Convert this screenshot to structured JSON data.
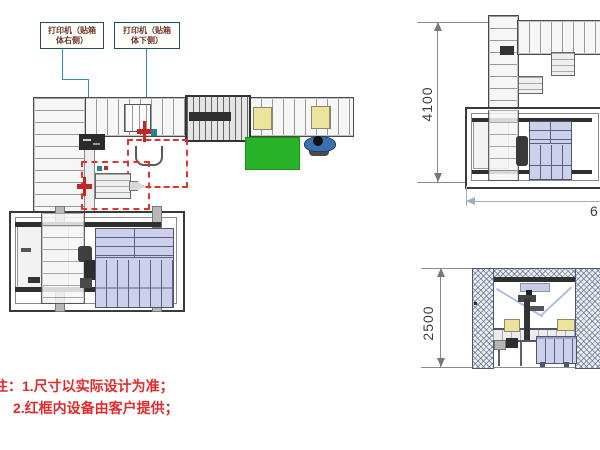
{
  "callouts": {
    "printer_right": {
      "line1": "打印机（贴箱",
      "line2": "体右侧）"
    },
    "printer_bottom": {
      "line1": "打印机（贴箱",
      "line2": "体下侧）"
    }
  },
  "dimensions": {
    "plan_height": "4100",
    "elevation_height": "2500",
    "plan_width_partial": "6"
  },
  "notes": {
    "line1": "注：1.尺寸以实际设计为准；",
    "line2": "2.红框内设备由客户提供；"
  },
  "colors": {
    "note_red": "#e02b2b",
    "customer_frame_red": "#e23333",
    "leader_teal": "#2f93a8",
    "green_mat": "#28b228",
    "carton_yellow": "#ece49c",
    "pallet_lavender": "#ccd0ea",
    "person_blue": "#3a70ad"
  }
}
